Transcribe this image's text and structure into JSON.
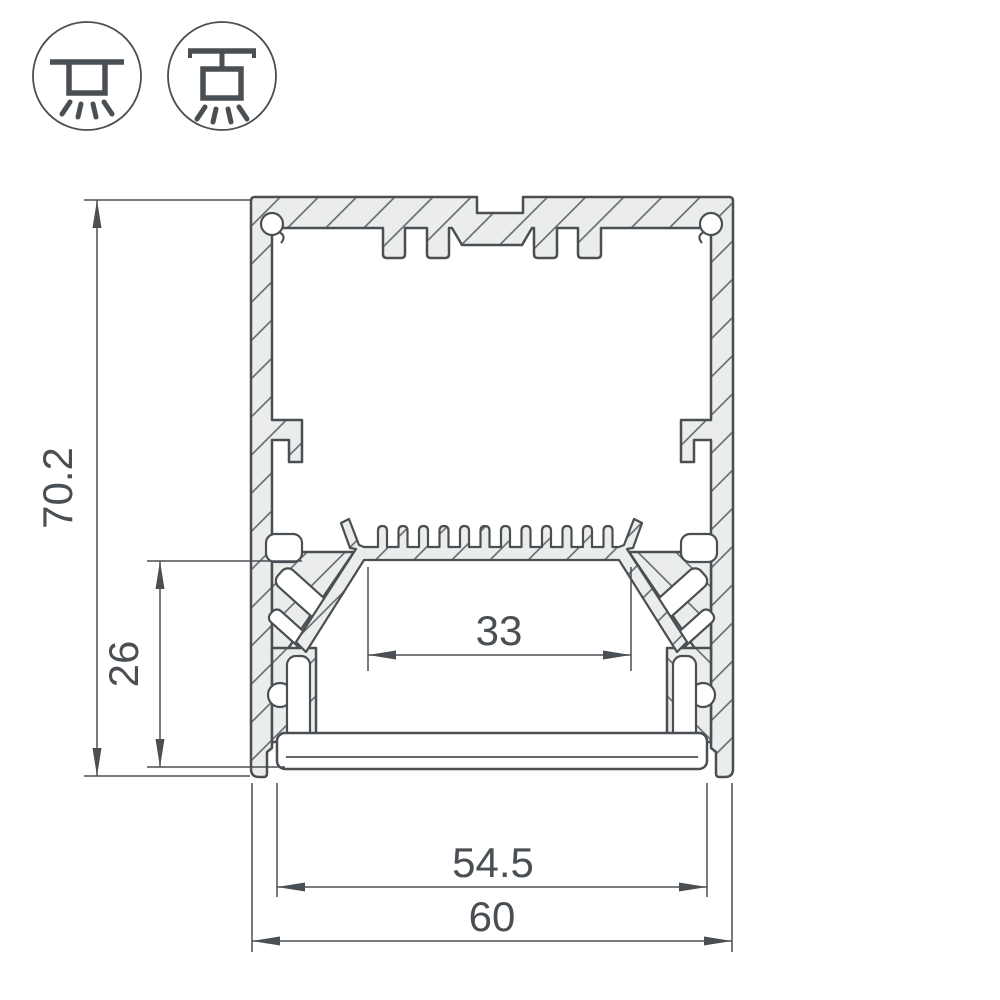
{
  "drawing": {
    "type": "technical-cross-section",
    "subject": "aluminum LED profile cross-section with dimensions",
    "colors": {
      "line": "#4a4f54",
      "metal_fill": "#ebecec",
      "hatch_line": "#5c6165",
      "background": "#ffffff"
    },
    "icons": [
      {
        "name": "surface-mount-light-icon",
        "meaning": "surface ceiling mount, light emitted downward"
      },
      {
        "name": "pendant-mount-light-icon",
        "meaning": "suspended pendant mount, light emitted downward"
      }
    ],
    "dimensions": {
      "total_height": {
        "label": "70.2",
        "orientation": "vertical"
      },
      "lower_inner_height": {
        "label": "26",
        "orientation": "vertical"
      },
      "inner_width": {
        "label": "33",
        "orientation": "horizontal"
      },
      "diffuser_width": {
        "label": "54.5",
        "orientation": "horizontal"
      },
      "total_width": {
        "label": "60",
        "orientation": "horizontal"
      }
    }
  }
}
